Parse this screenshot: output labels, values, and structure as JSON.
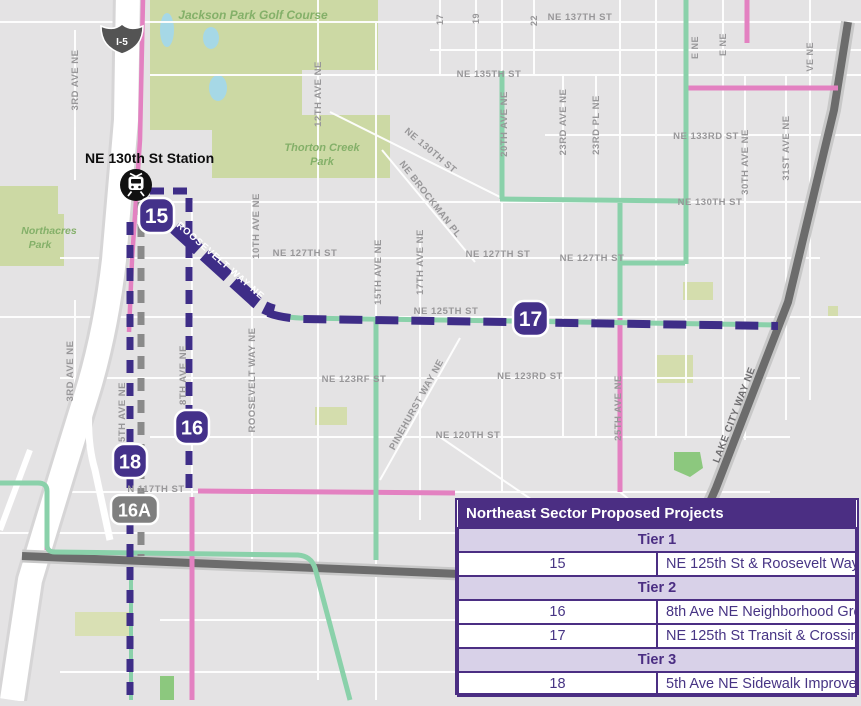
{
  "map": {
    "station_label": "NE 130th St Station",
    "interstate_shield": "I-5",
    "badges": {
      "b15": "15",
      "b16": "16",
      "b17": "17",
      "b18": "18",
      "b16a": "16A"
    },
    "roosevelt_on_route": "ROOSEVELT WAY NE",
    "street_labels": [
      "NE 137TH ST",
      "NE 135TH ST",
      "NE 133RD ST",
      "NE 130TH ST",
      "NE 130TH ST",
      "NE 127TH ST",
      "NE 127TH ST",
      "NE 127TH ST",
      "NE 125TH ST",
      "NE 123RD ST",
      "NE 123RF ST",
      "NE 120TH ST",
      "N 117TH ST",
      "3RD AVE NE",
      "3RD AVE NE",
      "5TH AVE NE",
      "8TH AVE NE",
      "10TH AVE NE",
      "12TH AVE NE",
      "15TH AVE NE",
      "17TH AVE NE",
      "20TH AVE NE",
      "23RD AVE NE",
      "23RD PL NE",
      "25TH AVE NE",
      "30TH AVE NE",
      "31ST AVE NE",
      "ROOSEVELT WAY NE",
      "PINEHURST WAY NE",
      "LAKE CITY WAY NE",
      "NE BROCKMAN PL",
      "17",
      "19",
      "22",
      "E NE",
      "E NE",
      "VE NE"
    ],
    "park_labels": [
      "Jackson Park Golf Course",
      "Thorton Creek",
      "Park",
      "Northacres",
      "Park"
    ],
    "colors": {
      "route_purple": "#3e2d87",
      "greenway_teal": "#8ad1aa",
      "pink_route": "#e381c1",
      "planned_gray": "#8a8a8a",
      "arterial_gray": "#6c6c6c",
      "park_green": "#ccd9a4",
      "table_header_purple": "#4b2e83",
      "tier_row_lavender": "#d8d1e8"
    }
  },
  "legend_table": {
    "title": "Northeast Sector Proposed Projects",
    "rows": [
      {
        "type": "tier",
        "label": "Tier 1"
      },
      {
        "type": "item",
        "id": "15",
        "name": "NE 125th St & Roosevelt Way NE Street Redesign"
      },
      {
        "type": "tier",
        "label": "Tier 2"
      },
      {
        "type": "item",
        "id": "16",
        "name": "8th Ave NE Neighborhood Greenway"
      },
      {
        "type": "item",
        "id": "17",
        "name": "NE 125th St Transit & Crossing Improvements"
      },
      {
        "type": "tier",
        "label": "Tier 3"
      },
      {
        "type": "item",
        "id": "18",
        "name": "5th Ave NE Sidewalk Improvements"
      }
    ]
  }
}
